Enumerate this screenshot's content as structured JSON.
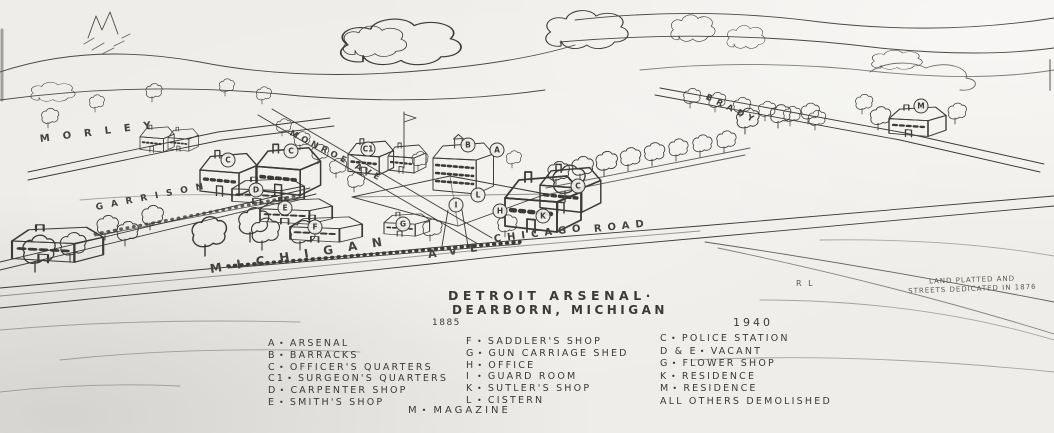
{
  "colors": {
    "ink": "#3c3a37",
    "paper": "#efede9",
    "faint": "#6b6965"
  },
  "header": {
    "title_line1": "DETROIT ARSENAL·",
    "title_line2": "DEARBORN, MICHIGAN",
    "year_left": "1885",
    "year_right": "1940",
    "note_line1": "LAND PLATTED AND",
    "note_line2": "STREETS DEDICATED IN 1876",
    "initials": "R L"
  },
  "streets": [
    {
      "name": "MORLEY",
      "x": 40,
      "y": 134,
      "rot": -7,
      "ls": 13,
      "fs": 10
    },
    {
      "name": "GARRISON",
      "x": 96,
      "y": 203,
      "rot": -11,
      "ls": 8,
      "fs": 9
    },
    {
      "name": "MICHIGAN",
      "x": 210,
      "y": 262,
      "rot": -9,
      "ls": 15,
      "fs": 12
    },
    {
      "name": "AVE",
      "x": 428,
      "y": 248,
      "rot": -8,
      "ls": 13,
      "fs": 11
    },
    {
      "name": "CHICAGO",
      "x": 494,
      "y": 234,
      "rot": -7,
      "ls": 6,
      "fs": 10
    },
    {
      "name": "ROAD",
      "x": 594,
      "y": 224,
      "rot": -6,
      "ls": 6,
      "fs": 10
    },
    {
      "name": "MONROE AVE",
      "x": 290,
      "y": 128,
      "rot": 27,
      "ls": 4,
      "fs": 8.5
    },
    {
      "name": "BRADY",
      "x": 706,
      "y": 92,
      "rot": 26,
      "ls": 5,
      "fs": 8.5
    }
  ],
  "legend_1885_col1": [
    {
      "key": "A",
      "sep": "•",
      "label": "ARSENAL"
    },
    {
      "key": "B",
      "sep": "•",
      "label": "BARRACKS"
    },
    {
      "key": "C",
      "sep": "•",
      "label": "OFFICER'S QUARTERS"
    },
    {
      "key": "C1",
      "sep": "•",
      "label": "SURGEON'S QUARTERS"
    },
    {
      "key": "D",
      "sep": "•",
      "label": "CARPENTER SHOP"
    },
    {
      "key": "E",
      "sep": "•",
      "label": "SMITH'S SHOP"
    }
  ],
  "legend_1885_col2": [
    {
      "key": "F",
      "sep": "•",
      "label": "SADDLER'S SHOP"
    },
    {
      "key": "G",
      "sep": "•",
      "label": "GUN CARRIAGE SHED"
    },
    {
      "key": "H",
      "sep": "•",
      "label": "OFFICE"
    },
    {
      "key": "I",
      "sep": "•",
      "label": "GUARD ROOM"
    },
    {
      "key": "K",
      "sep": "•",
      "label": "SUTLER'S SHOP"
    },
    {
      "key": "L",
      "sep": "•",
      "label": "CISTERN"
    }
  ],
  "legend_footer": [
    {
      "key": "M",
      "sep": "•",
      "label": "MAGAZINE"
    }
  ],
  "legend_1940": [
    {
      "key": "C",
      "sep": "•",
      "label": "POLICE STATION"
    },
    {
      "key": "D & E",
      "sep": "•",
      "label": "VACANT"
    },
    {
      "key": "G",
      "sep": "•",
      "label": "FLOWER SHOP"
    },
    {
      "key": "K",
      "sep": "•",
      "label": "RESIDENCE"
    },
    {
      "key": "M",
      "sep": "•",
      "label": "RESIDENCE"
    },
    {
      "key": "",
      "sep": "",
      "label": "ALL OTHERS DEMOLISHED"
    }
  ],
  "building_markers": [
    {
      "letter": "A",
      "x": 497,
      "y": 150
    },
    {
      "letter": "B",
      "x": 468,
      "y": 145
    },
    {
      "letter": "C",
      "x": 228,
      "y": 160
    },
    {
      "letter": "C",
      "x": 291,
      "y": 151
    },
    {
      "letter": "C1",
      "x": 368,
      "y": 149
    },
    {
      "letter": "D",
      "x": 256,
      "y": 190
    },
    {
      "letter": "E",
      "x": 285,
      "y": 208
    },
    {
      "letter": "F",
      "x": 315,
      "y": 227
    },
    {
      "letter": "G",
      "x": 403,
      "y": 224
    },
    {
      "letter": "H",
      "x": 500,
      "y": 211
    },
    {
      "letter": "I",
      "x": 456,
      "y": 205
    },
    {
      "letter": "K",
      "x": 543,
      "y": 216
    },
    {
      "letter": "L",
      "x": 478,
      "y": 195
    },
    {
      "letter": "C",
      "x": 578,
      "y": 186
    },
    {
      "letter": "M",
      "x": 921,
      "y": 106
    }
  ]
}
